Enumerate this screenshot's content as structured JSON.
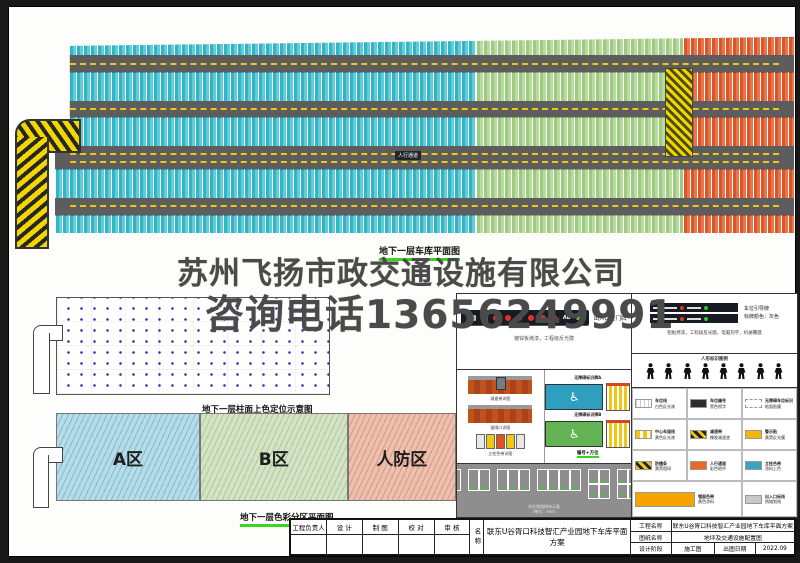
{
  "colors": {
    "stall_teal": "#2fb6c6",
    "stall_green": "#9cca7e",
    "stall_red": "#dd5426",
    "aisle_gray": "#5d5d5d",
    "lane_yellow": "#eec816",
    "zone_a_blue": "#b4dde9",
    "zone_b_green": "#d3e3c3",
    "zone_c_red": "#ecc0ad",
    "caption_underline_green": "#35d81f",
    "ramp_yellow": "#f2d600"
  },
  "watermark": {
    "company": "苏州飞扬市政交通设施有限公司",
    "phone": "咨询电话13656249991"
  },
  "garage": {
    "caption": "地下一层车库平面图",
    "center_label": "人行通道"
  },
  "columns_plan": {
    "caption": "地下一层柱面上色定位示意图"
  },
  "zoning_plan": {
    "caption": "地下一层色彩分区平面图",
    "zone_a": "A区",
    "zone_b": "B区",
    "zone_c": "人防区"
  },
  "panels": {
    "gantry": {
      "label": "出入口龙门牌",
      "ab": "AB",
      "arrow": "▲",
      "caption": "镀锌板烤漆，工程级反光膜"
    },
    "guide": {
      "title": "车位引导牌",
      "note": "标牌颜色：灰色",
      "caption": "铝板烤漆，工程级反光膜，电脑刻字，机械覆膜"
    },
    "picto": {
      "header": "人形标识图例"
    },
    "c": {
      "road1": "减速带详图",
      "road2": "道闸口详图",
      "colsline": "立柱色带详图",
      "board1_head": "无障碍标识牌A",
      "board2_head": "无障碍标识牌B",
      "board_glyph": "♿",
      "board_note": "编号+方位"
    },
    "d": {
      "line1": "车位划线排布示意",
      "line2": "（单位：mm）"
    },
    "legend": {
      "items": [
        {
          "t": "车位线",
          "s": "白色反光漆"
        },
        {
          "t": "车位编号",
          "s": "黑色喷字"
        },
        {
          "t": "无障碍车位标识",
          "s": "地面贴膜"
        },
        {
          "t": "中心车道线",
          "s": "黄色反光漆"
        },
        {
          "t": "减速带",
          "s": "橡胶减速垄"
        },
        {
          "t": "警示贴",
          "s": "黄黑反光膜"
        },
        {
          "t": "防撞条",
          "s": "黄黑相间"
        },
        {
          "t": "人行通道",
          "s": "彩色地坪"
        },
        {
          "t": "立柱色带",
          "s": "涂料上色"
        },
        {
          "t": "墙面色带",
          "s": "黄色涂料"
        },
        {
          "t": "出入口标线",
          "s": "热熔划线"
        }
      ]
    }
  },
  "titleblock": {
    "col_labels": [
      "工程负责人",
      "设 计",
      "制 图",
      "校 对",
      "审 核"
    ],
    "name_label": "名称",
    "name_value": "联东U谷胥口科技智汇产业园地下车库平面方案",
    "project_label": "工程名称",
    "project_value": "联东U谷胥口科技智汇产业园地下车库平面方案",
    "drawing_label": "图纸名称",
    "drawing_value": "地坪及交通设施配置图",
    "stage_label": "设计阶段",
    "stage_value": "施工图",
    "date_label": "出图日期",
    "date_value": "2022.09"
  }
}
